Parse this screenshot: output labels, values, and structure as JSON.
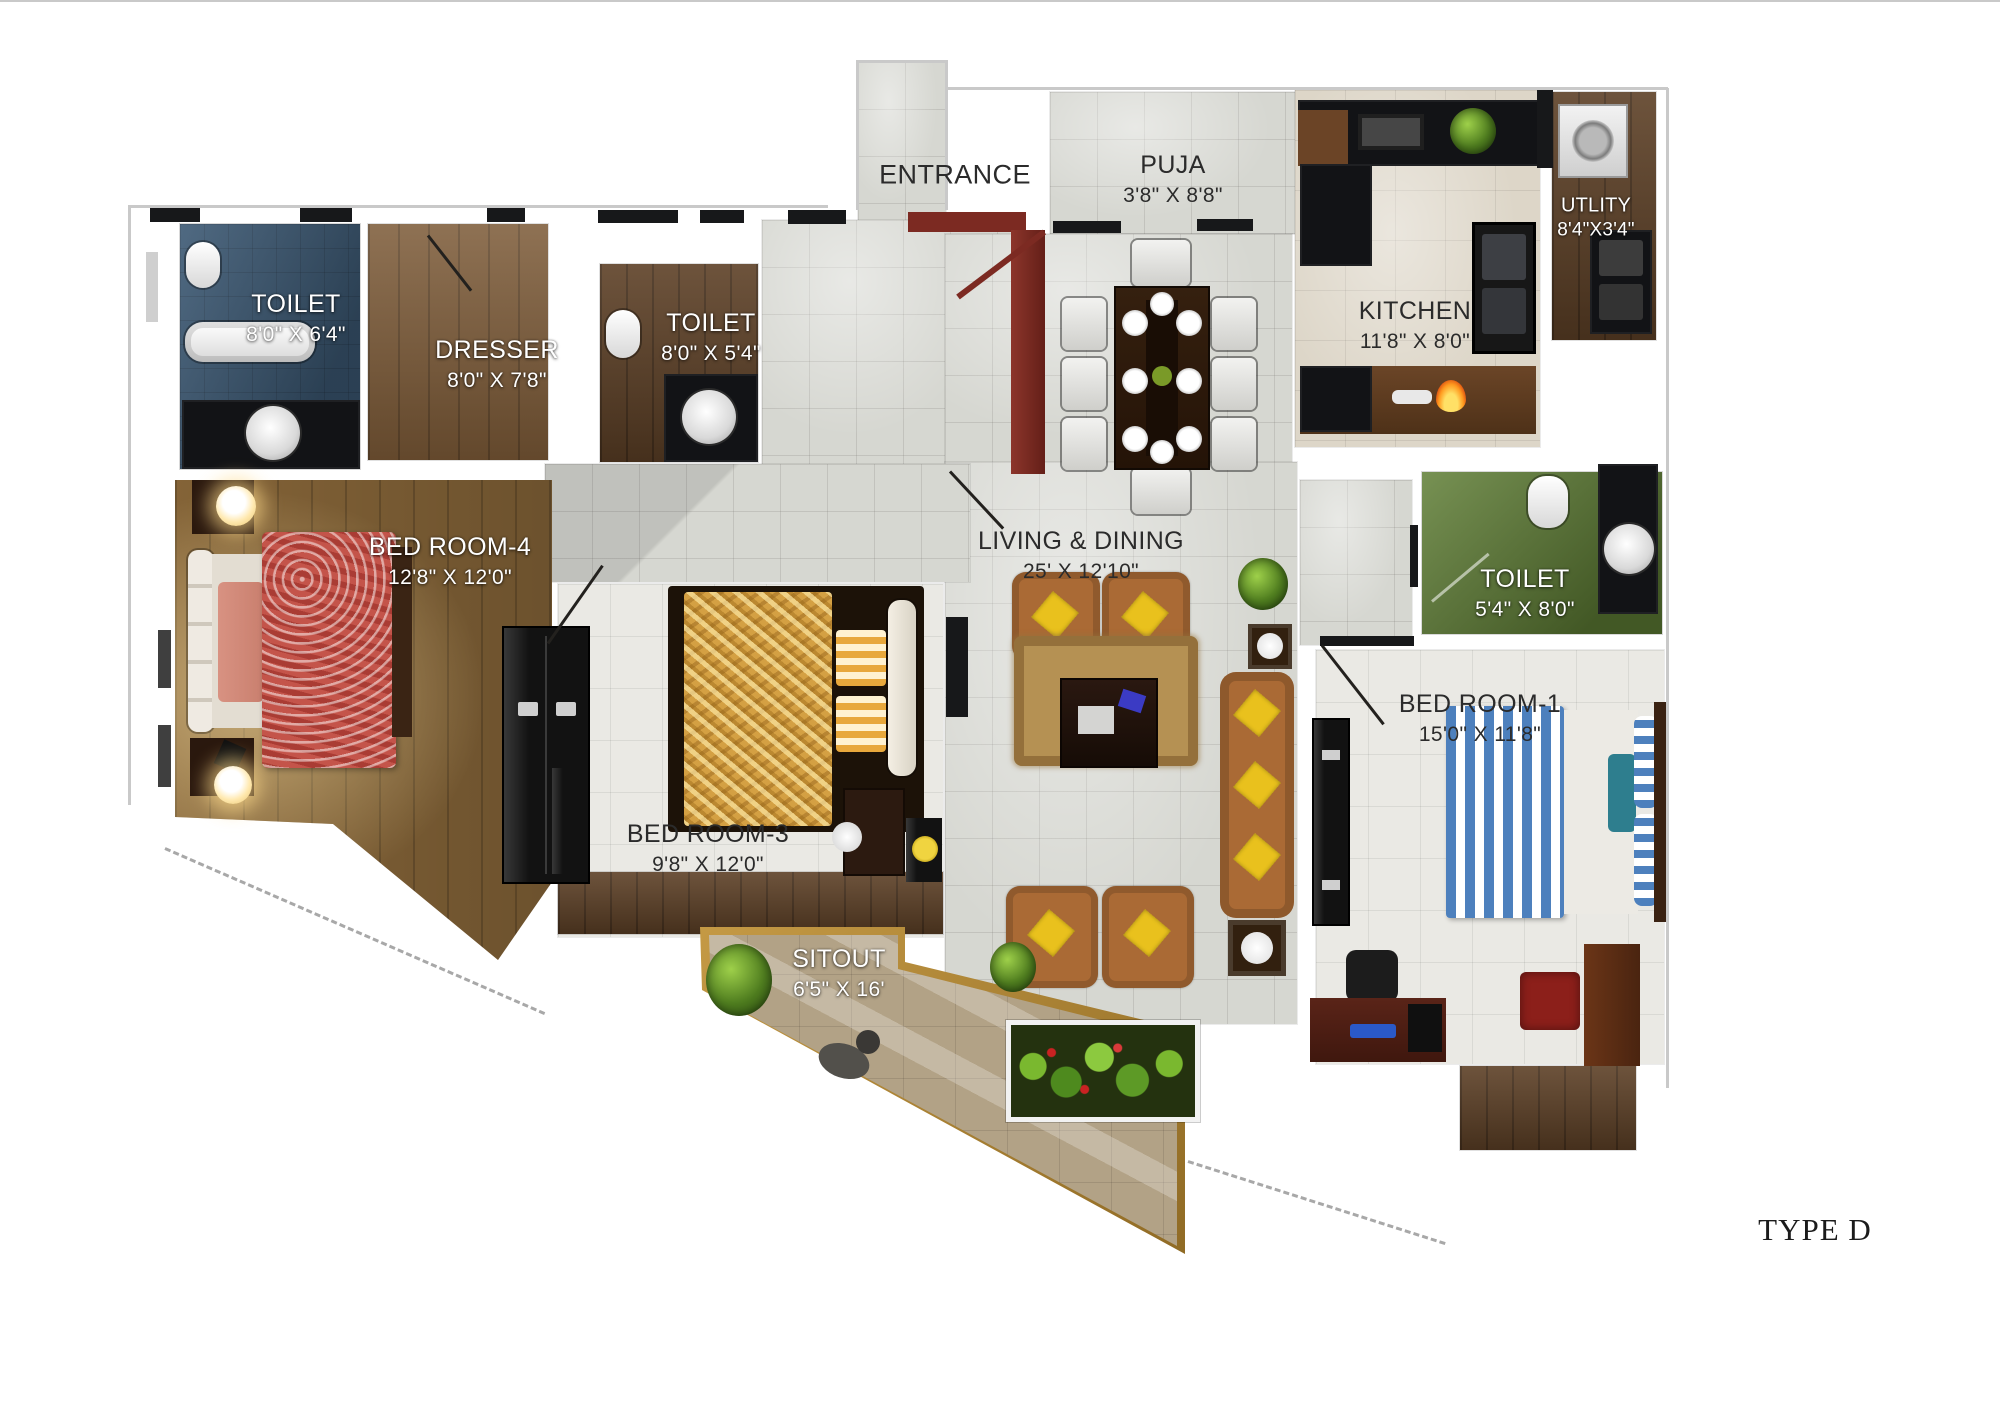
{
  "title": "TYPE D",
  "rooms": {
    "toilet4": {
      "name": "TOILET",
      "dims": "8'0\" X 6'4\""
    },
    "dresser": {
      "name": "DRESSER",
      "dims": "8'0\" X 7'8\""
    },
    "toilet3": {
      "name": "TOILET",
      "dims": "8'0\" X 5'4\""
    },
    "entrance": {
      "name": "ENTRANCE"
    },
    "puja": {
      "name": "PUJA",
      "dims": "3'8\" X 8'8\""
    },
    "kitchen": {
      "name": "KITCHEN",
      "dims": "11'8\" X 8'0\""
    },
    "utility": {
      "name": "UTLITY",
      "dims": "8'4\"X3'4\""
    },
    "bedroom4": {
      "name": "BED ROOM-4",
      "dims": "12'8\" X 12'0\""
    },
    "living": {
      "name": "LIVING & DINING",
      "dims": "25' X 12'10\""
    },
    "toilet1": {
      "name": "TOILET",
      "dims": "5'4\" X 8'0\""
    },
    "bedroom1": {
      "name": "BED ROOM-1",
      "dims": "15'0\" X 11'8\""
    },
    "bedroom3": {
      "name": "BED ROOM-3",
      "dims": "9'8\" X 12'0\""
    },
    "sitout": {
      "name": "SITOUT",
      "dims": "6'5\" X 16'"
    }
  },
  "colors": {
    "wall": "#ffffff",
    "tile_gray": "#d6d7d1",
    "tile_white": "#eae9e4",
    "wood_brown": "#7c5a37",
    "toilet_blue": "#3c5974",
    "toilet_green": "#5f7e35",
    "sitout_tan": "#b2a286",
    "sitout_frame_gold": "#a87f33",
    "entrance_door_maroon": "#7c2a22",
    "sofa_brown": "#aa6a35",
    "cushion_yellow": "#e9c11d",
    "bed4_red": "#c4544a",
    "bed3_gold": "#d4a043",
    "bed1_stripe_blue": "#4d80bd",
    "label_light": "#ffffff",
    "label_dark": "#2b2b2b"
  }
}
